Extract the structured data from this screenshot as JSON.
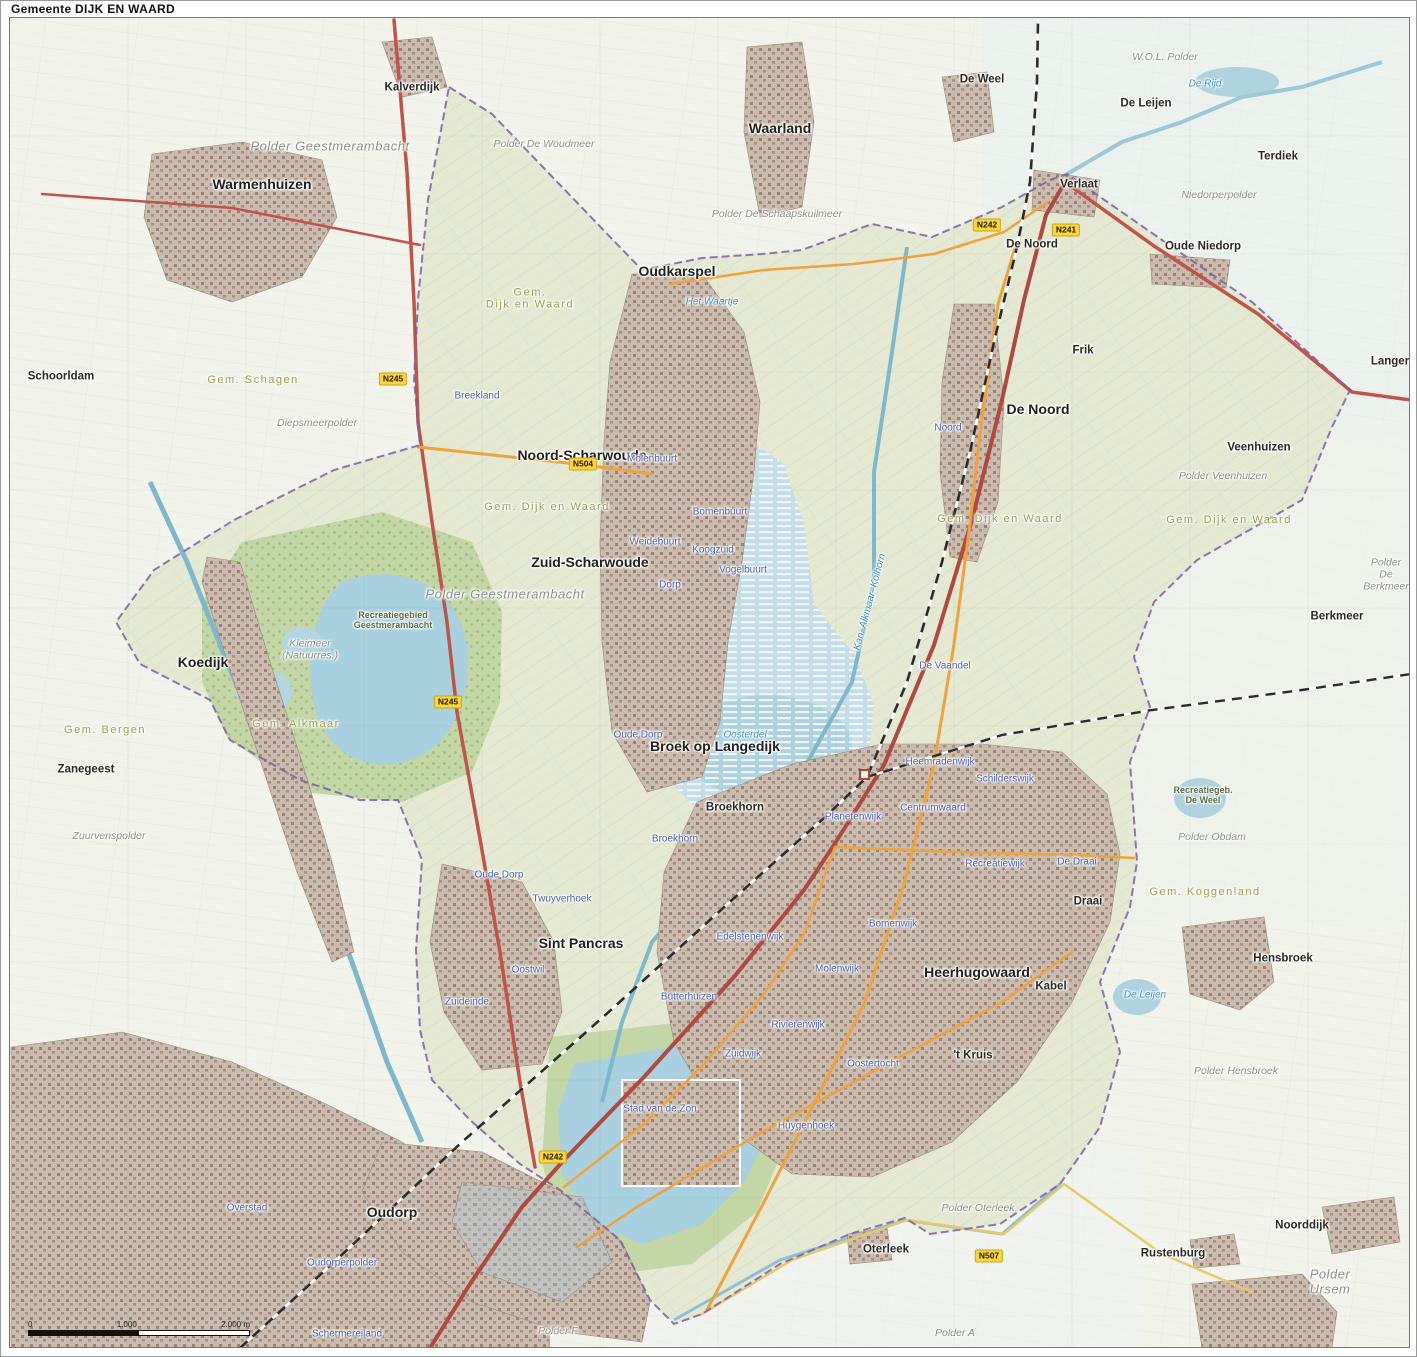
{
  "title": "Gemeente DIJK EN WAARD",
  "scalebar": {
    "zero": "0",
    "mid": "1.000",
    "end": "2.000 m"
  },
  "colors": {
    "outside_fill": "#f2f3ea",
    "municipality_fill": "#e4e8d0",
    "boundary": "#7b5ea7",
    "water": "#a8d0de",
    "urban": "#c6b8aa",
    "forest": "#a9c687",
    "park": "#c3d6a5",
    "road_major": "#c0544a",
    "road_secondary": "#f0a23c",
    "rail": "#2b2b2b",
    "shield_bg": "#fcd53a"
  },
  "map": {
    "labels": [
      {
        "t": "Kalverdijk",
        "x": 402,
        "y": 86,
        "c": "town",
        "n": "label-kalverdijk"
      },
      {
        "t": "Warmenhuizen",
        "x": 252,
        "y": 183,
        "c": "townlg",
        "n": "label-warmenhuizen"
      },
      {
        "t": "Waarland",
        "x": 770,
        "y": 127,
        "c": "townlg",
        "n": "label-waarland"
      },
      {
        "t": "Oudkarspel",
        "x": 667,
        "y": 270,
        "c": "townlg",
        "n": "label-oudkarspel"
      },
      {
        "t": "De Weel",
        "x": 972,
        "y": 78,
        "c": "town",
        "n": "label-de-weel"
      },
      {
        "t": "De Leijen",
        "x": 1136,
        "y": 102,
        "c": "town",
        "n": "label-de-leijen"
      },
      {
        "t": "Terdiek",
        "x": 1268,
        "y": 155,
        "c": "town",
        "n": "label-terdiek"
      },
      {
        "t": "Verlaat",
        "x": 1069,
        "y": 183,
        "c": "town",
        "n": "label-verlaat"
      },
      {
        "t": "De Noord",
        "x": 1022,
        "y": 243,
        "c": "town",
        "n": "label-de-noord-top"
      },
      {
        "t": "Oude Niedorp",
        "x": 1193,
        "y": 245,
        "c": "town",
        "n": "label-oude-niedorp"
      },
      {
        "t": "Langereis",
        "x": 1388,
        "y": 360,
        "c": "town",
        "n": "label-langereis"
      },
      {
        "t": "Frik",
        "x": 1073,
        "y": 349,
        "c": "town",
        "n": "label-frik"
      },
      {
        "t": "De Noord",
        "x": 1028,
        "y": 408,
        "c": "townlg",
        "n": "label-de-noord"
      },
      {
        "t": "Schoorldam",
        "x": 51,
        "y": 375,
        "c": "town",
        "n": "label-schoorldam"
      },
      {
        "t": "Noord-Scharwoude",
        "x": 572,
        "y": 454,
        "c": "townlg",
        "n": "label-noord-scharwoude"
      },
      {
        "t": "Veenhuizen",
        "x": 1249,
        "y": 446,
        "c": "town",
        "n": "label-veenhuizen"
      },
      {
        "t": "Zuid-Scharwoude",
        "x": 580,
        "y": 561,
        "c": "townlg",
        "n": "label-zuid-scharwoude"
      },
      {
        "t": "Berkmeer",
        "x": 1327,
        "y": 615,
        "c": "town",
        "n": "label-berkmeer"
      },
      {
        "t": "Koedijk",
        "x": 193,
        "y": 661,
        "c": "townlg",
        "n": "label-koedijk"
      },
      {
        "t": "Zanegeest",
        "x": 76,
        "y": 768,
        "c": "town",
        "n": "label-zanegeest"
      },
      {
        "t": "Broek op Langedijk",
        "x": 705,
        "y": 745,
        "c": "townlg",
        "n": "label-broek-op-langedijk"
      },
      {
        "t": "Broekhorn",
        "x": 725,
        "y": 806,
        "c": "town",
        "n": "label-broekhorn"
      },
      {
        "t": "Sint Pancras",
        "x": 571,
        "y": 942,
        "c": "townlg",
        "n": "label-sint-pancras"
      },
      {
        "t": "Heerhugowaard",
        "x": 967,
        "y": 971,
        "c": "townlg",
        "n": "label-heerhugowaard"
      },
      {
        "t": "Kabel",
        "x": 1041,
        "y": 985,
        "c": "town",
        "n": "label-kabel"
      },
      {
        "t": "Hensbroek",
        "x": 1273,
        "y": 957,
        "c": "town",
        "n": "label-hensbroek"
      },
      {
        "t": "Draai",
        "x": 1078,
        "y": 900,
        "c": "town",
        "n": "label-draai"
      },
      {
        "t": "'t Kruis",
        "x": 963,
        "y": 1054,
        "c": "town",
        "n": "label-t-kruis"
      },
      {
        "t": "Oudorp",
        "x": 382,
        "y": 1211,
        "c": "townlg",
        "n": "label-oudorp"
      },
      {
        "t": "Oterleek",
        "x": 876,
        "y": 1248,
        "c": "town",
        "n": "label-oterleek"
      },
      {
        "t": "Rustenburg",
        "x": 1163,
        "y": 1252,
        "c": "town",
        "n": "label-rustenburg"
      },
      {
        "t": "Noorddijk",
        "x": 1292,
        "y": 1224,
        "c": "town",
        "n": "label-noorddijk"
      },
      {
        "t": "Gem.\nDijk en Waard",
        "x": 520,
        "y": 297,
        "c": "muni",
        "n": "label-gem-dijk-en-waard"
      },
      {
        "t": "Gem. Dijk en Waard",
        "x": 537,
        "y": 505,
        "c": "muni",
        "n": "label-gem-dijk-en-waard"
      },
      {
        "t": "Gem. Dijk en Waard",
        "x": 990,
        "y": 517,
        "c": "muni",
        "n": "label-gem-dijk-en-waard"
      },
      {
        "t": "Gem. Dijk en Waard",
        "x": 1219,
        "y": 518,
        "c": "muni",
        "n": "label-gem-dijk-en-waard"
      },
      {
        "t": "Gem. Schagen",
        "x": 243,
        "y": 378,
        "c": "muni",
        "n": "label-gem-schagen"
      },
      {
        "t": "Gem. Alkmaar",
        "x": 286,
        "y": 722,
        "c": "muni",
        "n": "label-gem-alkmaar"
      },
      {
        "t": "Gem. Bergen",
        "x": 95,
        "y": 728,
        "c": "muni",
        "n": "label-gem-bergen"
      },
      {
        "t": "Gem. Koggenland",
        "x": 1195,
        "y": 890,
        "c": "muni",
        "n": "label-gem-koggenland"
      },
      {
        "t": "Polder Geestmerambacht",
        "x": 320,
        "y": 145,
        "c": "polderlg",
        "n": "label-polder-geestmerambacht"
      },
      {
        "t": "Polder Geestmerambacht",
        "x": 495,
        "y": 593,
        "c": "polderlg",
        "n": "label-polder-geestmerambacht"
      },
      {
        "t": "W.O.L. Polder",
        "x": 1155,
        "y": 56,
        "c": "polder",
        "n": "label-wol-polder"
      },
      {
        "t": "Polder De Woudmeer",
        "x": 534,
        "y": 143,
        "c": "polder",
        "n": "label-polder-de-woudmeer"
      },
      {
        "t": "Niedorperpolder",
        "x": 1209,
        "y": 194,
        "c": "polder",
        "n": "label-niedorperpolder"
      },
      {
        "t": "Polder De Schaapskuilmeer",
        "x": 767,
        "y": 213,
        "c": "polder",
        "n": "label-polder-de-schaapskuilmeer"
      },
      {
        "t": "Diepsmeerpolder",
        "x": 307,
        "y": 422,
        "c": "polder",
        "n": "label-diepsmeerpolder"
      },
      {
        "t": "Polder Veenhuizen",
        "x": 1213,
        "y": 475,
        "c": "polder",
        "n": "label-polder-veenhuizen"
      },
      {
        "t": "Polder De Berkmeer",
        "x": 1376,
        "y": 573,
        "c": "polder",
        "n": "label-polder-de-berkmeer"
      },
      {
        "t": "Kleimeer\n(Natuurres.)",
        "x": 300,
        "y": 648,
        "c": "polder",
        "n": "label-kleimeer"
      },
      {
        "t": "Zuurvenspolder",
        "x": 99,
        "y": 835,
        "c": "polder",
        "n": "label-zuurvenspolder"
      },
      {
        "t": "Polder Obdam",
        "x": 1202,
        "y": 836,
        "c": "polder",
        "n": "label-polder-obdam"
      },
      {
        "t": "Polder Hensbroek",
        "x": 1226,
        "y": 1070,
        "c": "polder",
        "n": "label-polder-hensbroek"
      },
      {
        "t": "Polder Oterleek",
        "x": 968,
        "y": 1207,
        "c": "polder",
        "n": "label-polder-oterleek"
      },
      {
        "t": "Polder Ursem",
        "x": 1320,
        "y": 1280,
        "c": "polderlg",
        "n": "label-polder-ursem"
      },
      {
        "t": "Polder A",
        "x": 945,
        "y": 1332,
        "c": "polder",
        "n": "label-polder-a"
      },
      {
        "t": "Polder F",
        "x": 548,
        "y": 1330,
        "c": "polder",
        "n": "label-polder-f"
      },
      {
        "t": "Recreatiegebied\nGeestmerambacht",
        "x": 383,
        "y": 618,
        "c": "green",
        "n": "label-recreatiegebied-geestmerambacht"
      },
      {
        "t": "Recreatiegeb.\nDe Weel",
        "x": 1193,
        "y": 793,
        "c": "green",
        "n": "label-recreatiegebied-de-weel"
      },
      {
        "t": "Breekland",
        "x": 467,
        "y": 394,
        "c": "hood",
        "n": "label-breekland"
      },
      {
        "t": "Molenbuurt",
        "x": 642,
        "y": 457,
        "c": "hood",
        "n": "label-molenbuurt"
      },
      {
        "t": "Bomenbuurt",
        "x": 710,
        "y": 510,
        "c": "hood",
        "n": "label-bomenbuurt"
      },
      {
        "t": "Weidebuurt",
        "x": 645,
        "y": 540,
        "c": "hood",
        "n": "label-weidebuurt"
      },
      {
        "t": "Koogzuid",
        "x": 703,
        "y": 548,
        "c": "hood",
        "n": "label-koogzuid"
      },
      {
        "t": "Vogelbuurt",
        "x": 733,
        "y": 568,
        "c": "hood",
        "n": "label-vogelbuurt"
      },
      {
        "t": "Dorp",
        "x": 660,
        "y": 583,
        "c": "hood",
        "n": "label-dorp"
      },
      {
        "t": "Oude Dorp",
        "x": 628,
        "y": 733,
        "c": "hood",
        "n": "label-oude-dorp"
      },
      {
        "t": "Broekhorn",
        "x": 665,
        "y": 837,
        "c": "hood",
        "n": "label-broekhorn-wijk"
      },
      {
        "t": "Oude Dorp",
        "x": 489,
        "y": 873,
        "c": "hood",
        "n": "label-oude-dorp-pancras"
      },
      {
        "t": "Twuyverhoek",
        "x": 552,
        "y": 897,
        "c": "hood",
        "n": "label-twuyverhoek"
      },
      {
        "t": "Oostwil",
        "x": 518,
        "y": 968,
        "c": "hood",
        "n": "label-oostwil"
      },
      {
        "t": "Zuideinde",
        "x": 457,
        "y": 1000,
        "c": "hood",
        "n": "label-zuideinde"
      },
      {
        "t": "Butterhuizen",
        "x": 679,
        "y": 995,
        "c": "hood",
        "n": "label-butterhuizen"
      },
      {
        "t": "Zuidwijk",
        "x": 733,
        "y": 1052,
        "c": "hood",
        "n": "label-zuidwijk"
      },
      {
        "t": "Stad van de Zon",
        "x": 650,
        "y": 1107,
        "c": "hood",
        "n": "label-stad-van-de-zon"
      },
      {
        "t": "Huygenhoek",
        "x": 796,
        "y": 1124,
        "c": "hood",
        "n": "label-huygenhoek"
      },
      {
        "t": "Oostertocht",
        "x": 863,
        "y": 1062,
        "c": "hood",
        "n": "label-oostertocht"
      },
      {
        "t": "Rivierenwijk",
        "x": 788,
        "y": 1023,
        "c": "hood",
        "n": "label-rivierenwijk"
      },
      {
        "t": "Edelstenenwijk",
        "x": 740,
        "y": 935,
        "c": "hood",
        "n": "label-edelstenenwijk"
      },
      {
        "t": "Molenwijk",
        "x": 827,
        "y": 967,
        "c": "hood",
        "n": "label-molenwijk"
      },
      {
        "t": "Bomenwijk",
        "x": 883,
        "y": 922,
        "c": "hood",
        "n": "label-bomenwijk"
      },
      {
        "t": "Heemradenwijk",
        "x": 930,
        "y": 760,
        "c": "hood",
        "n": "label-heemradenwijk"
      },
      {
        "t": "Schilderswijk",
        "x": 995,
        "y": 777,
        "c": "hood",
        "n": "label-schilderswijk"
      },
      {
        "t": "Centrumwaard",
        "x": 923,
        "y": 806,
        "c": "hood",
        "n": "label-centrumwaard"
      },
      {
        "t": "Planetenwijk",
        "x": 843,
        "y": 815,
        "c": "hood",
        "n": "label-planetenwijk"
      },
      {
        "t": "De Draai",
        "x": 1067,
        "y": 860,
        "c": "hood",
        "n": "label-de-draai"
      },
      {
        "t": "Recreatiewijk",
        "x": 985,
        "y": 862,
        "c": "hood",
        "n": "label-recreatiewijk"
      },
      {
        "t": "De Vaandel",
        "x": 935,
        "y": 664,
        "c": "hood",
        "n": "label-de-vaandel"
      },
      {
        "t": "Noord",
        "x": 938,
        "y": 426,
        "c": "hood",
        "n": "label-noord"
      },
      {
        "t": "Overstad",
        "x": 237,
        "y": 1206,
        "c": "hood",
        "n": "label-overstad"
      },
      {
        "t": "Oudorperpolder",
        "x": 332,
        "y": 1261,
        "c": "hood",
        "n": "label-oudorperpolder"
      },
      {
        "t": "Schermereiland",
        "x": 337,
        "y": 1332,
        "c": "hood",
        "n": "label-schermereiland"
      },
      {
        "t": "Het Waartje",
        "x": 702,
        "y": 300,
        "c": "water",
        "n": "label-het-waartje"
      },
      {
        "t": "De Rijd",
        "x": 1195,
        "y": 82,
        "c": "water",
        "n": "label-de-rijd"
      },
      {
        "t": "Oosterdel",
        "x": 735,
        "y": 733,
        "c": "water",
        "n": "label-oosterdel"
      },
      {
        "t": "Kan. Alkmaar–Kolhorn",
        "x": 860,
        "y": 600,
        "c": "water",
        "r": -75,
        "n": "label-kanaal-alkmaar-kolhorn"
      },
      {
        "t": "De Leijen",
        "x": 1135,
        "y": 993,
        "c": "water",
        "n": "label-de-leijen-lake"
      },
      {
        "t": "N245",
        "x": 383,
        "y": 377,
        "c": "shield",
        "n": "shield-n245"
      },
      {
        "t": "N245",
        "x": 438,
        "y": 700,
        "c": "shield",
        "n": "shield-n245"
      },
      {
        "t": "N504",
        "x": 573,
        "y": 462,
        "c": "shield",
        "n": "shield-n504"
      },
      {
        "t": "N242",
        "x": 977,
        "y": 223,
        "c": "shield",
        "n": "shield-n242"
      },
      {
        "t": "N241",
        "x": 1056,
        "y": 228,
        "c": "shield",
        "n": "shield-n241"
      },
      {
        "t": "N242",
        "x": 543,
        "y": 1155,
        "c": "shield",
        "n": "shield-n242"
      },
      {
        "t": "N507",
        "x": 979,
        "y": 1254,
        "c": "shield",
        "n": "shield-n507"
      }
    ]
  }
}
